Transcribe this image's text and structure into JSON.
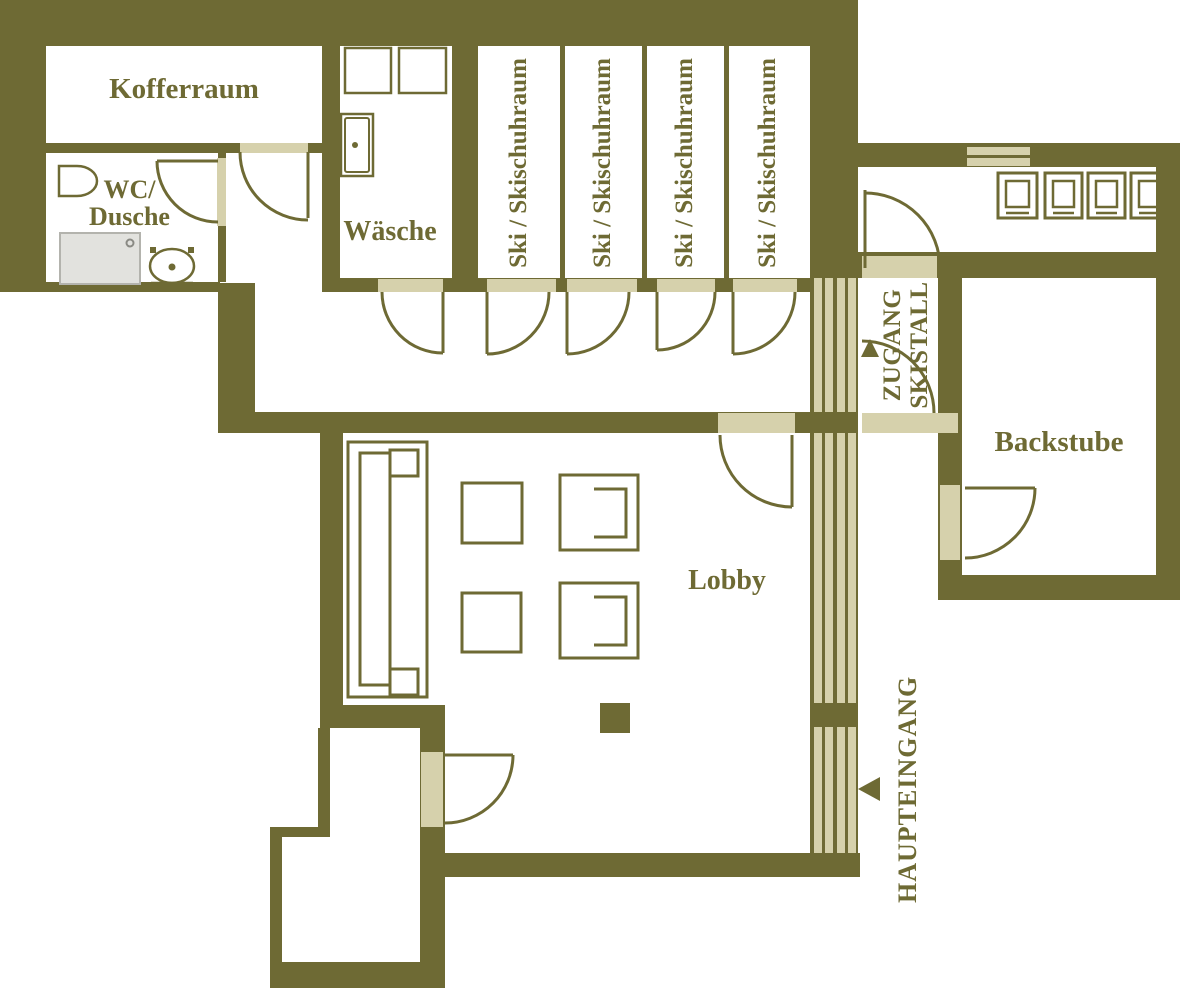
{
  "colors": {
    "wall_olive": "#6e6a34",
    "accent_beige": "#d6d1ac",
    "shower_gray": "#e2e2de",
    "background": "#ffffff"
  },
  "rooms": {
    "kofferraum": {
      "label": "Kofferraum"
    },
    "wc_dusche": {
      "line1": "WC/",
      "line2": "Dusche"
    },
    "waesche": {
      "label": "Wäsche"
    },
    "ski_rooms": [
      {
        "label": "Ski / Skischuhraum"
      },
      {
        "label": "Ski / Skischuhraum"
      },
      {
        "label": "Ski / Skischuhraum"
      },
      {
        "label": "Ski / Skischuhraum"
      }
    ],
    "lobby": {
      "label": "Lobby"
    },
    "backstube": {
      "label": "Backstube"
    }
  },
  "annotations": {
    "zugang_skistall": {
      "line1": "ZUGANG",
      "line2": "SKISTALL",
      "arrow_icon": "up-arrow"
    },
    "haupteingang": {
      "label": "HAUPTEINGANG",
      "arrow_icon": "left-arrow"
    }
  },
  "fixtures": {
    "wc_dusche": [
      "wc-sink-icon",
      "shower-icon",
      "toilet-icon"
    ],
    "waesche": [
      "washing-machine-icon",
      "washing-machine-icon",
      "laundry-sink-icon"
    ],
    "lobby": [
      "sofa-icon",
      "coffee-table-icon",
      "coffee-table-icon",
      "armchair-icon",
      "armchair-icon",
      "pillar-icon"
    ],
    "backstube_corridor": [
      "oven-icon",
      "oven-icon",
      "oven-icon",
      "oven-icon",
      "window-icon"
    ],
    "facade": [
      "glass-front-icon"
    ]
  }
}
